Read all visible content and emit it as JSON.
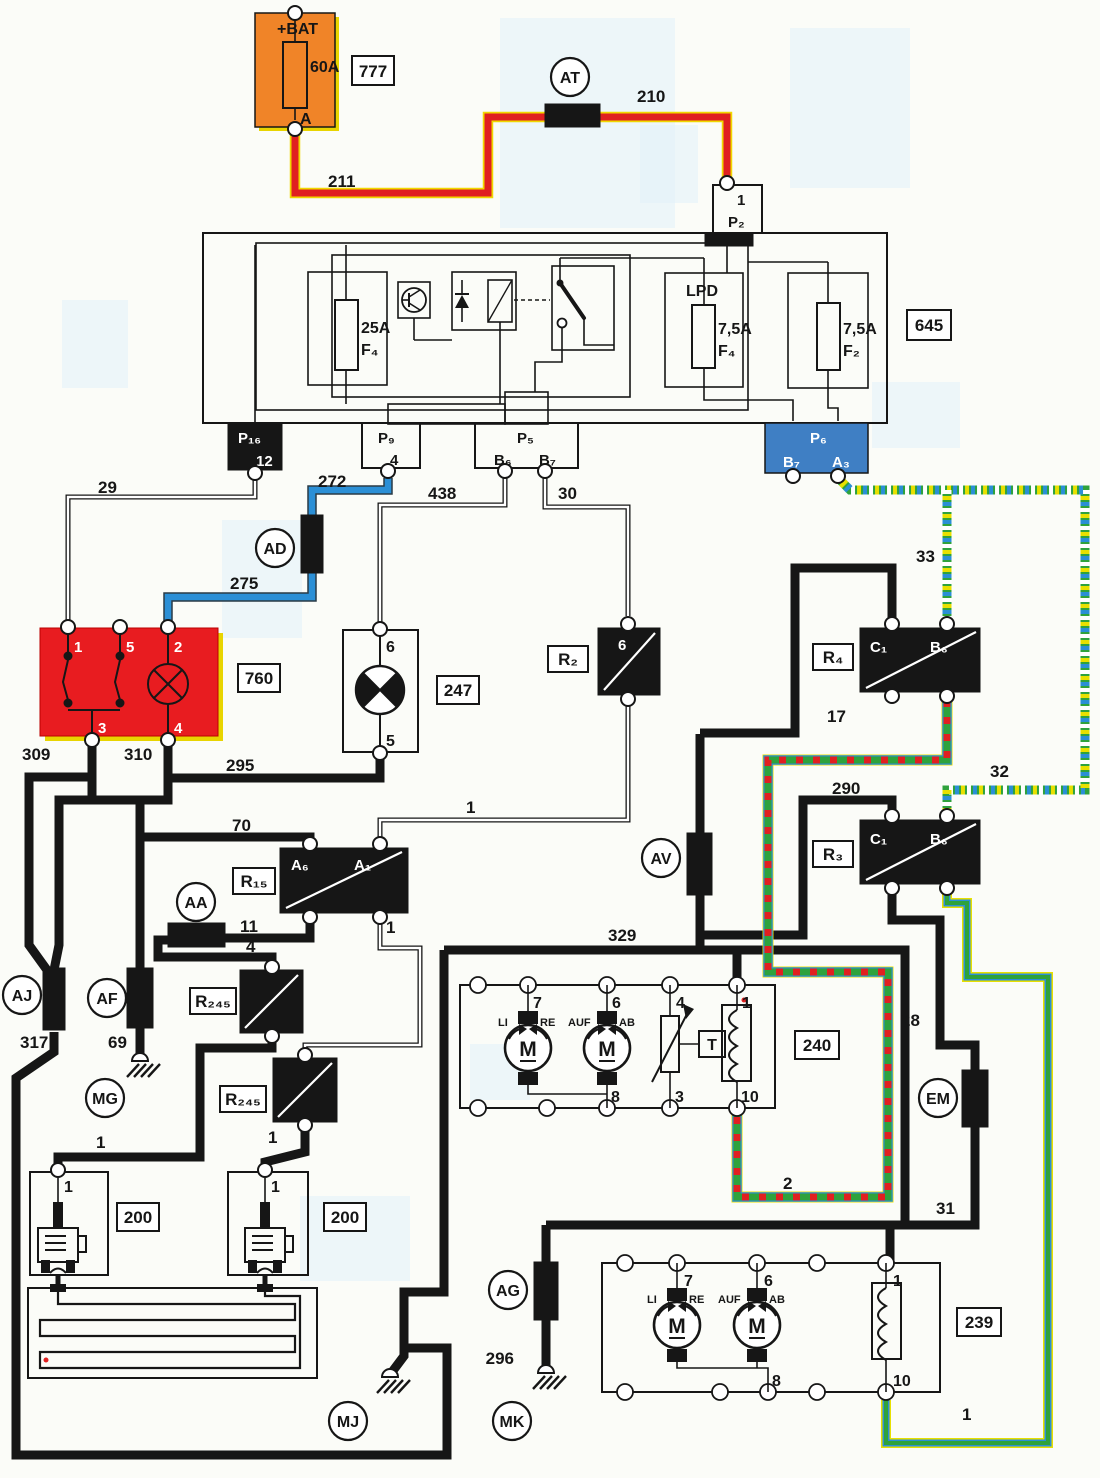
{
  "diagram_type": "automotive wiring schematic",
  "colors": {
    "wire_red": "#e02020",
    "wire_red_edge": "#f0d800",
    "wire_blue": "#2b8fd6",
    "wire_green": "#2fa23c",
    "stripe_blue": "#2b8fd6",
    "stripe_yellow": "#e8e000",
    "stripe_red": "#e02020",
    "box_orange": "#f08428",
    "box_red": "#e81c20",
    "box_blue": "#3f7fc4",
    "ink": "#161616"
  },
  "labels": {
    "bat": "+BAT",
    "a60": "60A",
    "pinA": "A",
    "r777": "777",
    "at": "AT",
    "w210": "210",
    "w211": "211",
    "p2": "P₂",
    "r645": "645",
    "f25": "25A",
    "f25n": "F₄",
    "lpd": "LPD",
    "f75a": "7,5A",
    "f75an": "F₄",
    "f75b": "7,5A",
    "f75bn": "F₂",
    "p16": "P₁₆",
    "p16pin": "12",
    "p9": "P₉",
    "p5": "P₅",
    "p5b6": "B₆",
    "p5b7": "B₇",
    "p6": "P₆",
    "p6b7": "B₇",
    "p6a3": "A₃",
    "w29": "29",
    "w272": "272",
    "ad": "AD",
    "w275": "275",
    "w438": "438",
    "w30": "30",
    "w33": "33",
    "w32": "32",
    "s1": "1",
    "s2": "2",
    "s3": "3",
    "s4": "4",
    "s5": "5",
    "s6": "6",
    "s7": "7",
    "s8": "8",
    "s10": "10",
    "r760": "760",
    "r247": "247",
    "r2": "R₂",
    "r4": "R₄",
    "r3": "R₃",
    "r15": "R₁₅",
    "r245": "R₂₄₅",
    "r240": "240",
    "r239": "239",
    "r200": "200",
    "c1": "C₁",
    "b6": "B₆",
    "a6": "A₆",
    "a1": "A₁",
    "w17": "17",
    "w290": "290",
    "w28": "28",
    "w31": "31",
    "w309": "309",
    "w310": "310",
    "w295": "295",
    "w70": "70",
    "w11": "11",
    "w317": "317",
    "w69": "69",
    "w329": "329",
    "w296": "296",
    "aa": "AA",
    "af": "AF",
    "aj": "AJ",
    "mg": "MG",
    "mj": "MJ",
    "mk": "MK",
    "ag": "AG",
    "av": "AV",
    "em": "EM",
    "li": "LI",
    "re": "RE",
    "auf": "AUF",
    "ab": "AB",
    "mm": "M",
    "tt": "T"
  }
}
